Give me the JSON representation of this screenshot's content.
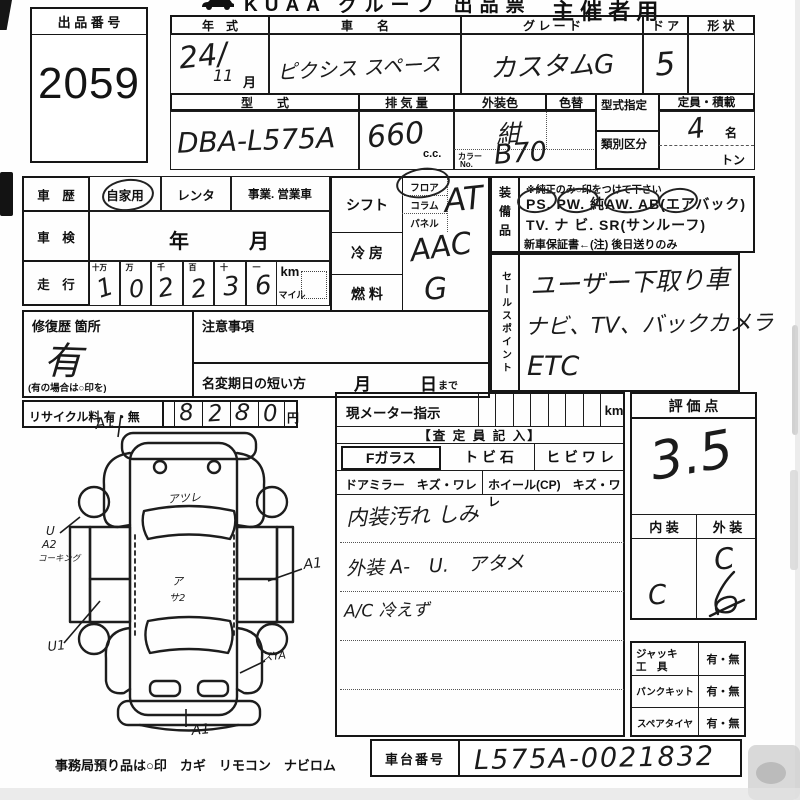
{
  "header": {
    "title": "KUAA グループ 出品票",
    "audience": "主 催 者 用"
  },
  "exhibit": {
    "label": "出 品 番 号",
    "number": "2059"
  },
  "vehicle": {
    "year_label": "年　式",
    "year_value": "24/",
    "year_month": "11",
    "month_suffix": "月",
    "name_label": "車　　名",
    "name_value": "ピクシス スペース",
    "grade_label": "グ レ ー ド",
    "grade_value": "カスタムG",
    "door_label": "ド ア",
    "door_value": "5",
    "shape_label": "形 状",
    "model_label": "型　　式",
    "model_value": "DBA-L575A",
    "disp_label": "排 気 量",
    "disp_value": "660",
    "disp_unit": "c.c.",
    "color_label": "外装色",
    "color_value": "紺",
    "color_change_label": "色替",
    "color_no_label1": "カラー",
    "color_no_label2": "No.",
    "color_no_value": "B70",
    "type_desig_label": "型式指定",
    "class_label": "類別区分",
    "capacity_label": "定員・積載",
    "capacity_value": "4",
    "capacity_unit": "名",
    "ton_label": "トン"
  },
  "history": {
    "label": "車　歴",
    "opt1": "自家用",
    "opt2": "レンタ",
    "opt3": "事業. 営業車"
  },
  "shaken": {
    "label": "車　検",
    "year": "年",
    "month": "月"
  },
  "mileage": {
    "label": "走　行",
    "headers": [
      "十万",
      "万",
      "千",
      "百",
      "十",
      "一"
    ],
    "digits": [
      "1",
      "0",
      "2",
      "2",
      "3",
      "6"
    ],
    "km": "km",
    "mile": "マイル"
  },
  "repair": {
    "label": "修復歴 箇所",
    "value": "有",
    "note": "(有の場合は○印を)"
  },
  "caution": {
    "label": "注意事項",
    "rename_label": "名変期日の短い方",
    "month": "月",
    "day": "日",
    "made": "まで"
  },
  "recycle": {
    "label": "リサイクル料 有・無",
    "digits": [
      "8",
      "2",
      "8",
      "0"
    ],
    "yen": "円"
  },
  "shift": {
    "label": "シフト",
    "floor": "フロア",
    "column": "コラム",
    "panel": "パネル",
    "value": "AT"
  },
  "cooling": {
    "label": "冷 房",
    "value": "AAC"
  },
  "fuel": {
    "label": "燃 料",
    "value": "G"
  },
  "equipment": {
    "label": "装備品",
    "note": "※純正のみ○印をつけて下さい",
    "line1": "PS.  PW.  純AW.  AB(エアバック)",
    "line2": "TV.  ナ ビ.  SR(サンルーフ)",
    "line3": "新車保証書←(注) 後日送りのみ"
  },
  "sales": {
    "label": "セールスポイント",
    "line1": "ユーザー下取り車",
    "line2": "ナビ、TV、バックカメラ",
    "line3": "ETC"
  },
  "meter": {
    "label": "現メーター指示",
    "km": "km",
    "assessor": "【査 定 員 記 入】",
    "fglass": "Fガラス",
    "stone": "ト ビ 石",
    "crack": "ヒ ビ ワ レ",
    "mirror": "ドアミラー　キズ・ワレ",
    "wheel": "ホイール(CP)　キズ・ワレ",
    "note1": "内装汚れ しみ",
    "note2": "外装 A-　U.　アタメ",
    "note3": "A/C 冷えず"
  },
  "evaluation": {
    "label": "評 価 点",
    "score": "3.5",
    "interior_label": "内 装",
    "exterior_label": "外 装",
    "interior": "C",
    "exterior": "C"
  },
  "tools": {
    "jack1": "ジャッキ",
    "jack2": "工　具",
    "jack_opt": "有・無",
    "puncture": "パンクキット",
    "puncture_opt": "有・無",
    "spare": "スペアタイヤ",
    "spare_opt": "有・無"
  },
  "chassis": {
    "label": "車台番号",
    "value": "L575A-0021832"
  },
  "footer": {
    "text": "事務局預り品は○印　カギ　リモコン　ナビロム"
  },
  "diagram": {
    "annotations": [
      "A1",
      "アツレ",
      "U",
      "A2",
      "コーキング",
      "ア",
      "サ2",
      "A1",
      "U1",
      "スYA",
      "A1"
    ]
  }
}
